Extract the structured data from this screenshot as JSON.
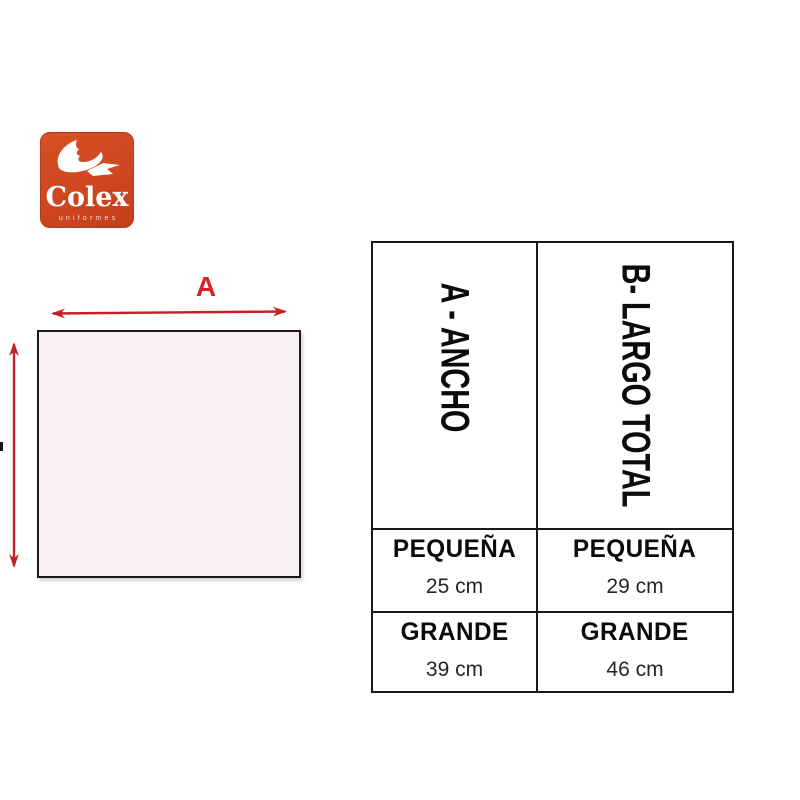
{
  "logo": {
    "brand": "Colex",
    "tagline": "uniformes"
  },
  "diagram": {
    "width_label": "A"
  },
  "size_table": {
    "columns": [
      {
        "header": "A - ANCHO",
        "rows": [
          {
            "size_label": "PEQUEÑA",
            "value": "25 cm"
          },
          {
            "size_label": "GRANDE",
            "value": "39 cm"
          }
        ]
      },
      {
        "header": "B- LARGO TOTAL",
        "rows": [
          {
            "size_label": "PEQUEÑA",
            "value": "29 cm"
          },
          {
            "size_label": "GRANDE",
            "value": "46 cm"
          }
        ]
      }
    ]
  },
  "colors": {
    "logo_background": "#cf4720",
    "accent_red": "#c32125",
    "label_red": "#da1f26",
    "square_fill": "#f8f0f1",
    "table_border": "#1a1a1a"
  }
}
